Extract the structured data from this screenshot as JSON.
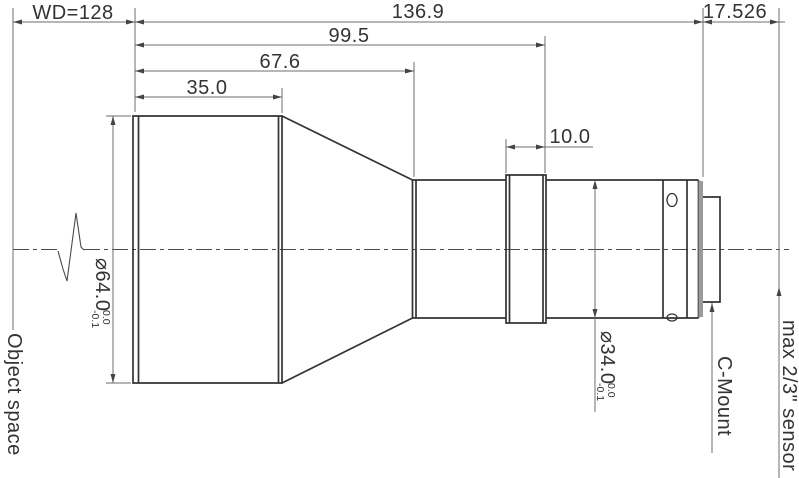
{
  "drawing": {
    "dimensions": {
      "wd": "WD=128",
      "total_length": "136.9",
      "flange_distance": "17.526",
      "dim_99_5": "99.5",
      "dim_67_6": "67.6",
      "dim_35_0": "35.0",
      "dim_10_0": "10.0"
    },
    "diameters": {
      "front": {
        "value": "⌀64.0",
        "tol_upper": "0.0",
        "tol_lower": "-0.1"
      },
      "rear": {
        "value": "⌀34.0",
        "tol_upper": "0.0",
        "tol_lower": "-0.1"
      }
    },
    "annotations": {
      "object_space": "Object space",
      "c_mount": "C-Mount",
      "max_sensor": "max 2/3\" sensor"
    },
    "colors": {
      "background": "#ffffff",
      "outline": "#333333",
      "dimension_lines": "#6e6e6e",
      "centerline": "#4a4a4a",
      "text": "#333333",
      "flange_face": "#9a9a9a"
    }
  }
}
